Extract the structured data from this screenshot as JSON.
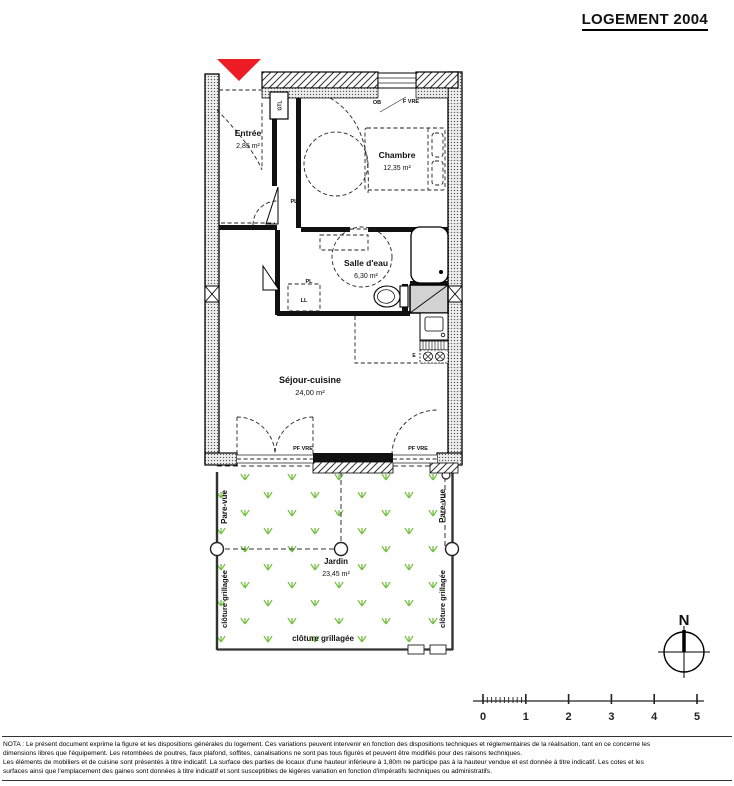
{
  "title": "LOGEMENT 2004",
  "rooms": {
    "entree": {
      "name": "Entrée",
      "area": "2,85 m²"
    },
    "chambre": {
      "name": "Chambre",
      "area": "12,35 m²"
    },
    "salle_eau": {
      "name": "Salle d'eau",
      "area": "6,30 m²"
    },
    "sejour": {
      "name": "Séjour-cuisine",
      "area": "24,00 m²"
    },
    "jardin": {
      "name": "Jardin",
      "area": "23,45 m²"
    }
  },
  "annotations": {
    "gtl": "GTL",
    "pl_entree": "PL",
    "pl_hall": "PL",
    "ll": "LL",
    "window_type": "OB",
    "window_shutter": "F VRE",
    "door_left_label": "PF VRE",
    "door_right_label": "PF VRE",
    "kitchen_e": "E",
    "pare_vue_left": "Pare-vue",
    "pare_vue_right": "Pare-vue",
    "cloture_left": "clôture grillagée",
    "cloture_right": "clôture grillagée",
    "cloture_bottom": "clôture grillagée",
    "north": "N"
  },
  "scale_bar": {
    "ticks": [
      "0",
      "1",
      "2",
      "3",
      "4",
      "5"
    ]
  },
  "nota": {
    "line1": "NOTA : Le présent document exprime la figure et les dispositions générales du logement. Ces variations peuvent intervenir en fonction des dispositions techniques et réglementaires de la réalisation, tant en ce concerne les",
    "line2": "dimensions libres que l'équipement. Les retombées de poutres, faux plafond, soffites, canalisations ne sont pas tous figurés et peuvent être modifiés pour des raisons techniques.",
    "line3": "Les éléments de mobiliers et de cuisine sont présentés à titre indicatif. La surface des parties de locaux d'une hauteur inférieure à 1,80m ne participe pas à la hauteur vendue et est donnée à titre indicatif. Les cotes et les",
    "line4": "surfaces ainsi que l'emplacement des gaines sont données à titre indicatif et sont susceptibles de légères variation en fonction d'impératifs techniques ou administratifs."
  },
  "colors": {
    "entrance_arrow_red": "#ED1C24",
    "grass_green": "#76C043"
  }
}
